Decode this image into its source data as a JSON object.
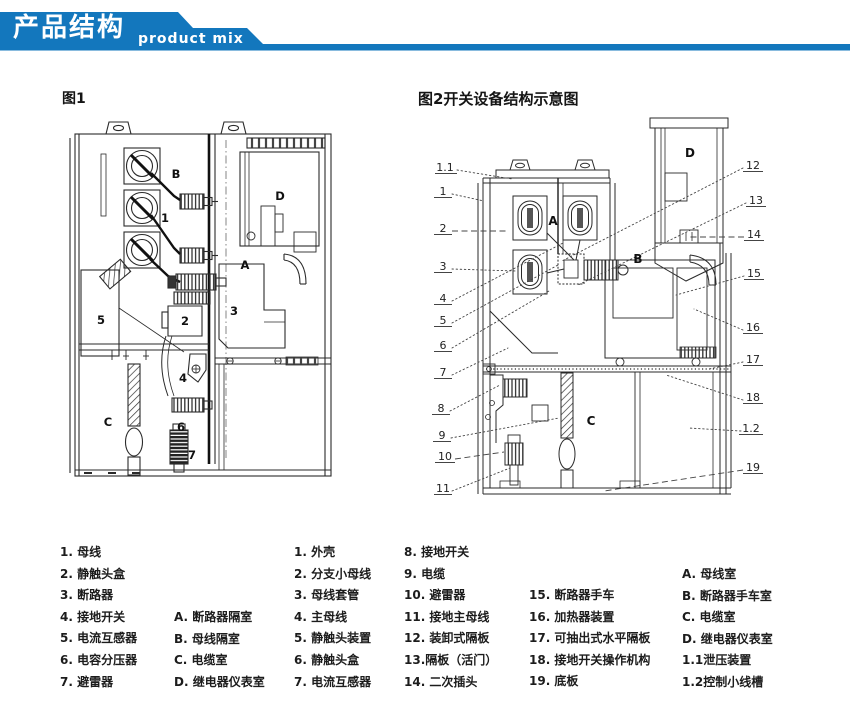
{
  "header": {
    "title_zh": "产品结构",
    "title_en": "product mix",
    "accent_color": "#1377bd"
  },
  "fig1": {
    "title": "图1",
    "labels": [
      "B",
      "1",
      "D",
      "A",
      "5",
      "2",
      "3",
      "4",
      "C",
      "6",
      "7"
    ]
  },
  "fig2": {
    "title": "图2开关设备结构示意图",
    "left_callouts": [
      "1.1",
      "1",
      "2",
      "3",
      "4",
      "5",
      "6",
      "7",
      "8",
      "9",
      "10",
      "11"
    ],
    "right_callouts": [
      "12",
      "13",
      "14",
      "15",
      "16",
      "17",
      "18",
      "1.2",
      "19"
    ],
    "inner": [
      "A",
      "B",
      "C",
      "D"
    ]
  },
  "legend": {
    "fig1_items": [
      "1. 母线",
      "2. 静触头盒",
      "3. 断路器",
      "4. 接地开关",
      "5. 电流互感器",
      "6. 电容分压器",
      "7. 避雷器"
    ],
    "fig1_compartments": [
      "A. 断路器隔室",
      "B. 母线隔室",
      "C. 电缆室",
      "D. 继电器仪表室"
    ],
    "fig2_items_a": [
      "1. 外壳",
      "2. 分支小母线",
      "3. 母线套管",
      "4. 主母线",
      "5. 静触头装置",
      "6. 静触头盒",
      "7. 电流互感器"
    ],
    "fig2_items_b": [
      "8. 接地开关",
      "9. 电缆",
      "10. 避雷器",
      "11. 接地主母线",
      "12. 装卸式隔板",
      "13.隔板（活门）",
      "14. 二次插头"
    ],
    "fig2_items_c": [
      "15. 断路器手车",
      "16. 加热器装置",
      "17. 可抽出式水平隔板",
      "18. 接地开关操作机构",
      "19. 底板"
    ],
    "fig2_compartments": [
      "A.  母线室",
      "B.  断路器手车室",
      "C.  电缆室",
      "D.  继电器仪表室",
      "1.1泄压装置",
      "1.2控制小线槽"
    ]
  }
}
